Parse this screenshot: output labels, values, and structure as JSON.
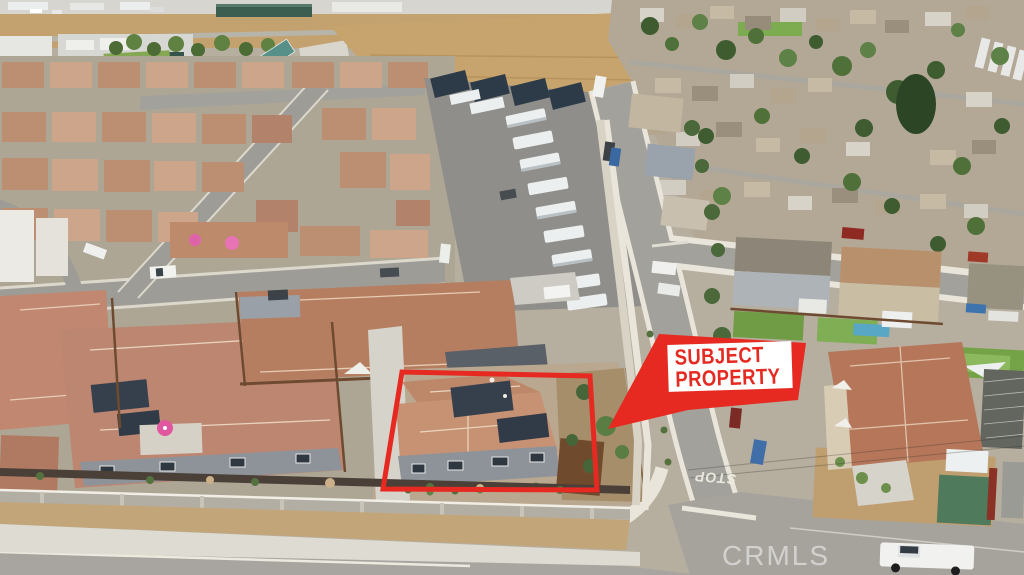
{
  "photo": {
    "alt": "Aerial drone photo of a suburban neighborhood; a single-story home with solar panels is outlined in red, with an RV storage lot, new tile-roof subdivision on the left, an older tree-filled neighborhood on the right, and an industrial area with dirt fields at the top"
  },
  "annotations": {
    "subject_label": {
      "line1": "SUBJECT",
      "line2": "PROPERTY"
    },
    "road_marking": "STOP",
    "watermark": "CRMLS"
  },
  "colors": {
    "annotation_red": "#e62a22",
    "label_background": "#ffffff",
    "watermark_text": "rgba(255,255,255,0.5)",
    "road_marking_text": "#efece2"
  },
  "palette": {
    "asphalt": "#a3a19b",
    "new_roof_tile": "#c28d6f",
    "dirt_field": "#c7a46d",
    "tree_green": "#3e5c30",
    "concrete": "#e6e2d6",
    "solar_panel": "#36404c",
    "teal_roof": "#579088"
  }
}
